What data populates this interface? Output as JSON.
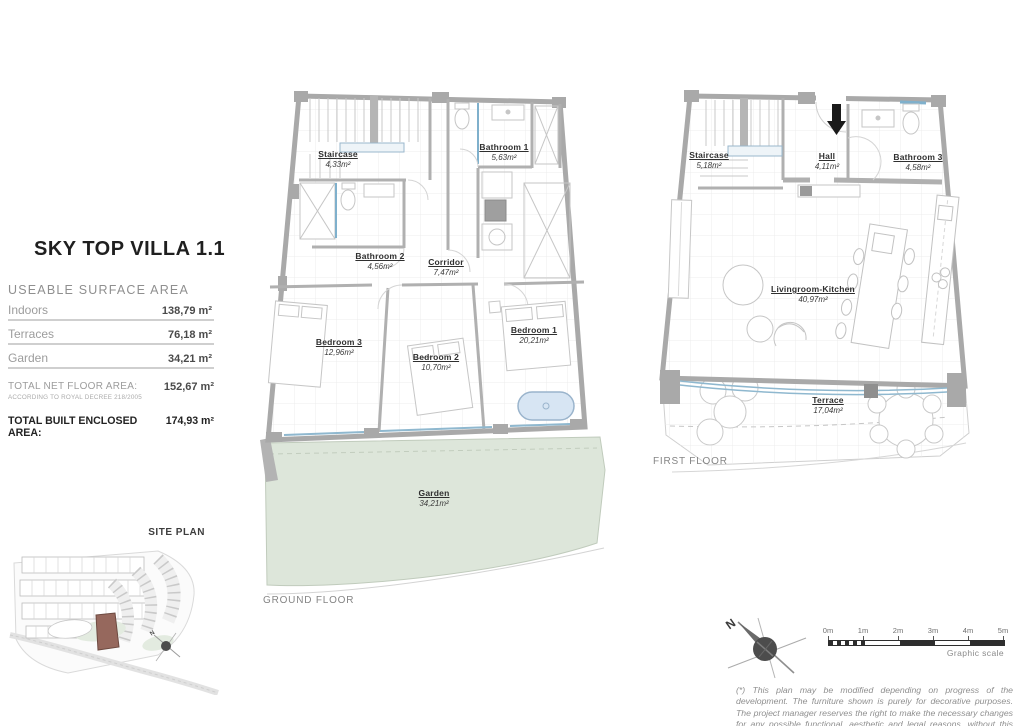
{
  "panel": {
    "title": "SKY TOP VILLA 1.1",
    "section_title": "USEABLE SURFACE AREA",
    "rows": [
      {
        "label": "Indoors",
        "value": "138,79 m²"
      },
      {
        "label": "Terraces",
        "value": "76,18 m²"
      },
      {
        "label": "Garden",
        "value": "34,21 m²"
      }
    ],
    "total_net_label": "TOTAL NET FLOOR AREA:",
    "total_net_note": "ACCORDING TO ROYAL DECREE 218/2005",
    "total_net_value": "152,67 m²",
    "total_built_label": "TOTAL BUILT ENCLOSED AREA:",
    "total_built_value": "174,93 m²"
  },
  "site_plan": {
    "label": "SITE PLAN"
  },
  "ground_floor": {
    "label": "GROUND FLOOR",
    "rooms": {
      "staircase": {
        "name": "Staircase",
        "area": "4,33m²"
      },
      "bathroom1": {
        "name": "Bathroom 1",
        "area": "5,63m²"
      },
      "bathroom2": {
        "name": "Bathroom 2",
        "area": "4,56m²"
      },
      "corridor": {
        "name": "Corridor",
        "area": "7,47m²"
      },
      "bedroom3": {
        "name": "Bedroom 3",
        "area": "12,96m²"
      },
      "bedroom2": {
        "name": "Bedroom 2",
        "area": "10,70m²"
      },
      "bedroom1": {
        "name": "Bedroom 1",
        "area": "20,21m²"
      },
      "garden": {
        "name": "Garden",
        "area": "34,21m²"
      }
    }
  },
  "first_floor": {
    "label": "FIRST FLOOR",
    "rooms": {
      "staircase": {
        "name": "Staircase",
        "area": "5,18m²"
      },
      "hall": {
        "name": "Hall",
        "area": "4,11m²"
      },
      "bathroom3": {
        "name": "Bathroom 3",
        "area": "4,58m²"
      },
      "living": {
        "name": "Livingroom-Kitchen",
        "area": "40,97m²"
      },
      "terrace": {
        "name": "Terrace",
        "area": "17,04m²"
      }
    }
  },
  "compass": {
    "north": "N"
  },
  "scale": {
    "ticks": [
      "0m",
      "1m",
      "2m",
      "3m",
      "4m",
      "5m"
    ],
    "label": "Graphic scale"
  },
  "disclaimer": "(*) This plan may be modified depending on progress of the development. The furniture shown is purely for decorative purposes. The project manager reserves the right to make the necessary changes for any possible functional, aesthetic and legal reasons, without this negatively affecting the quality of the construction. Illustrative dimensions.",
  "colors": {
    "wall_gray": "#a9a9a9",
    "garden_green": "#dde6da",
    "window_blue": "#8fb8cf",
    "bathtub_blue": "#d7e5f3",
    "plot_highlight": "#96685d"
  }
}
